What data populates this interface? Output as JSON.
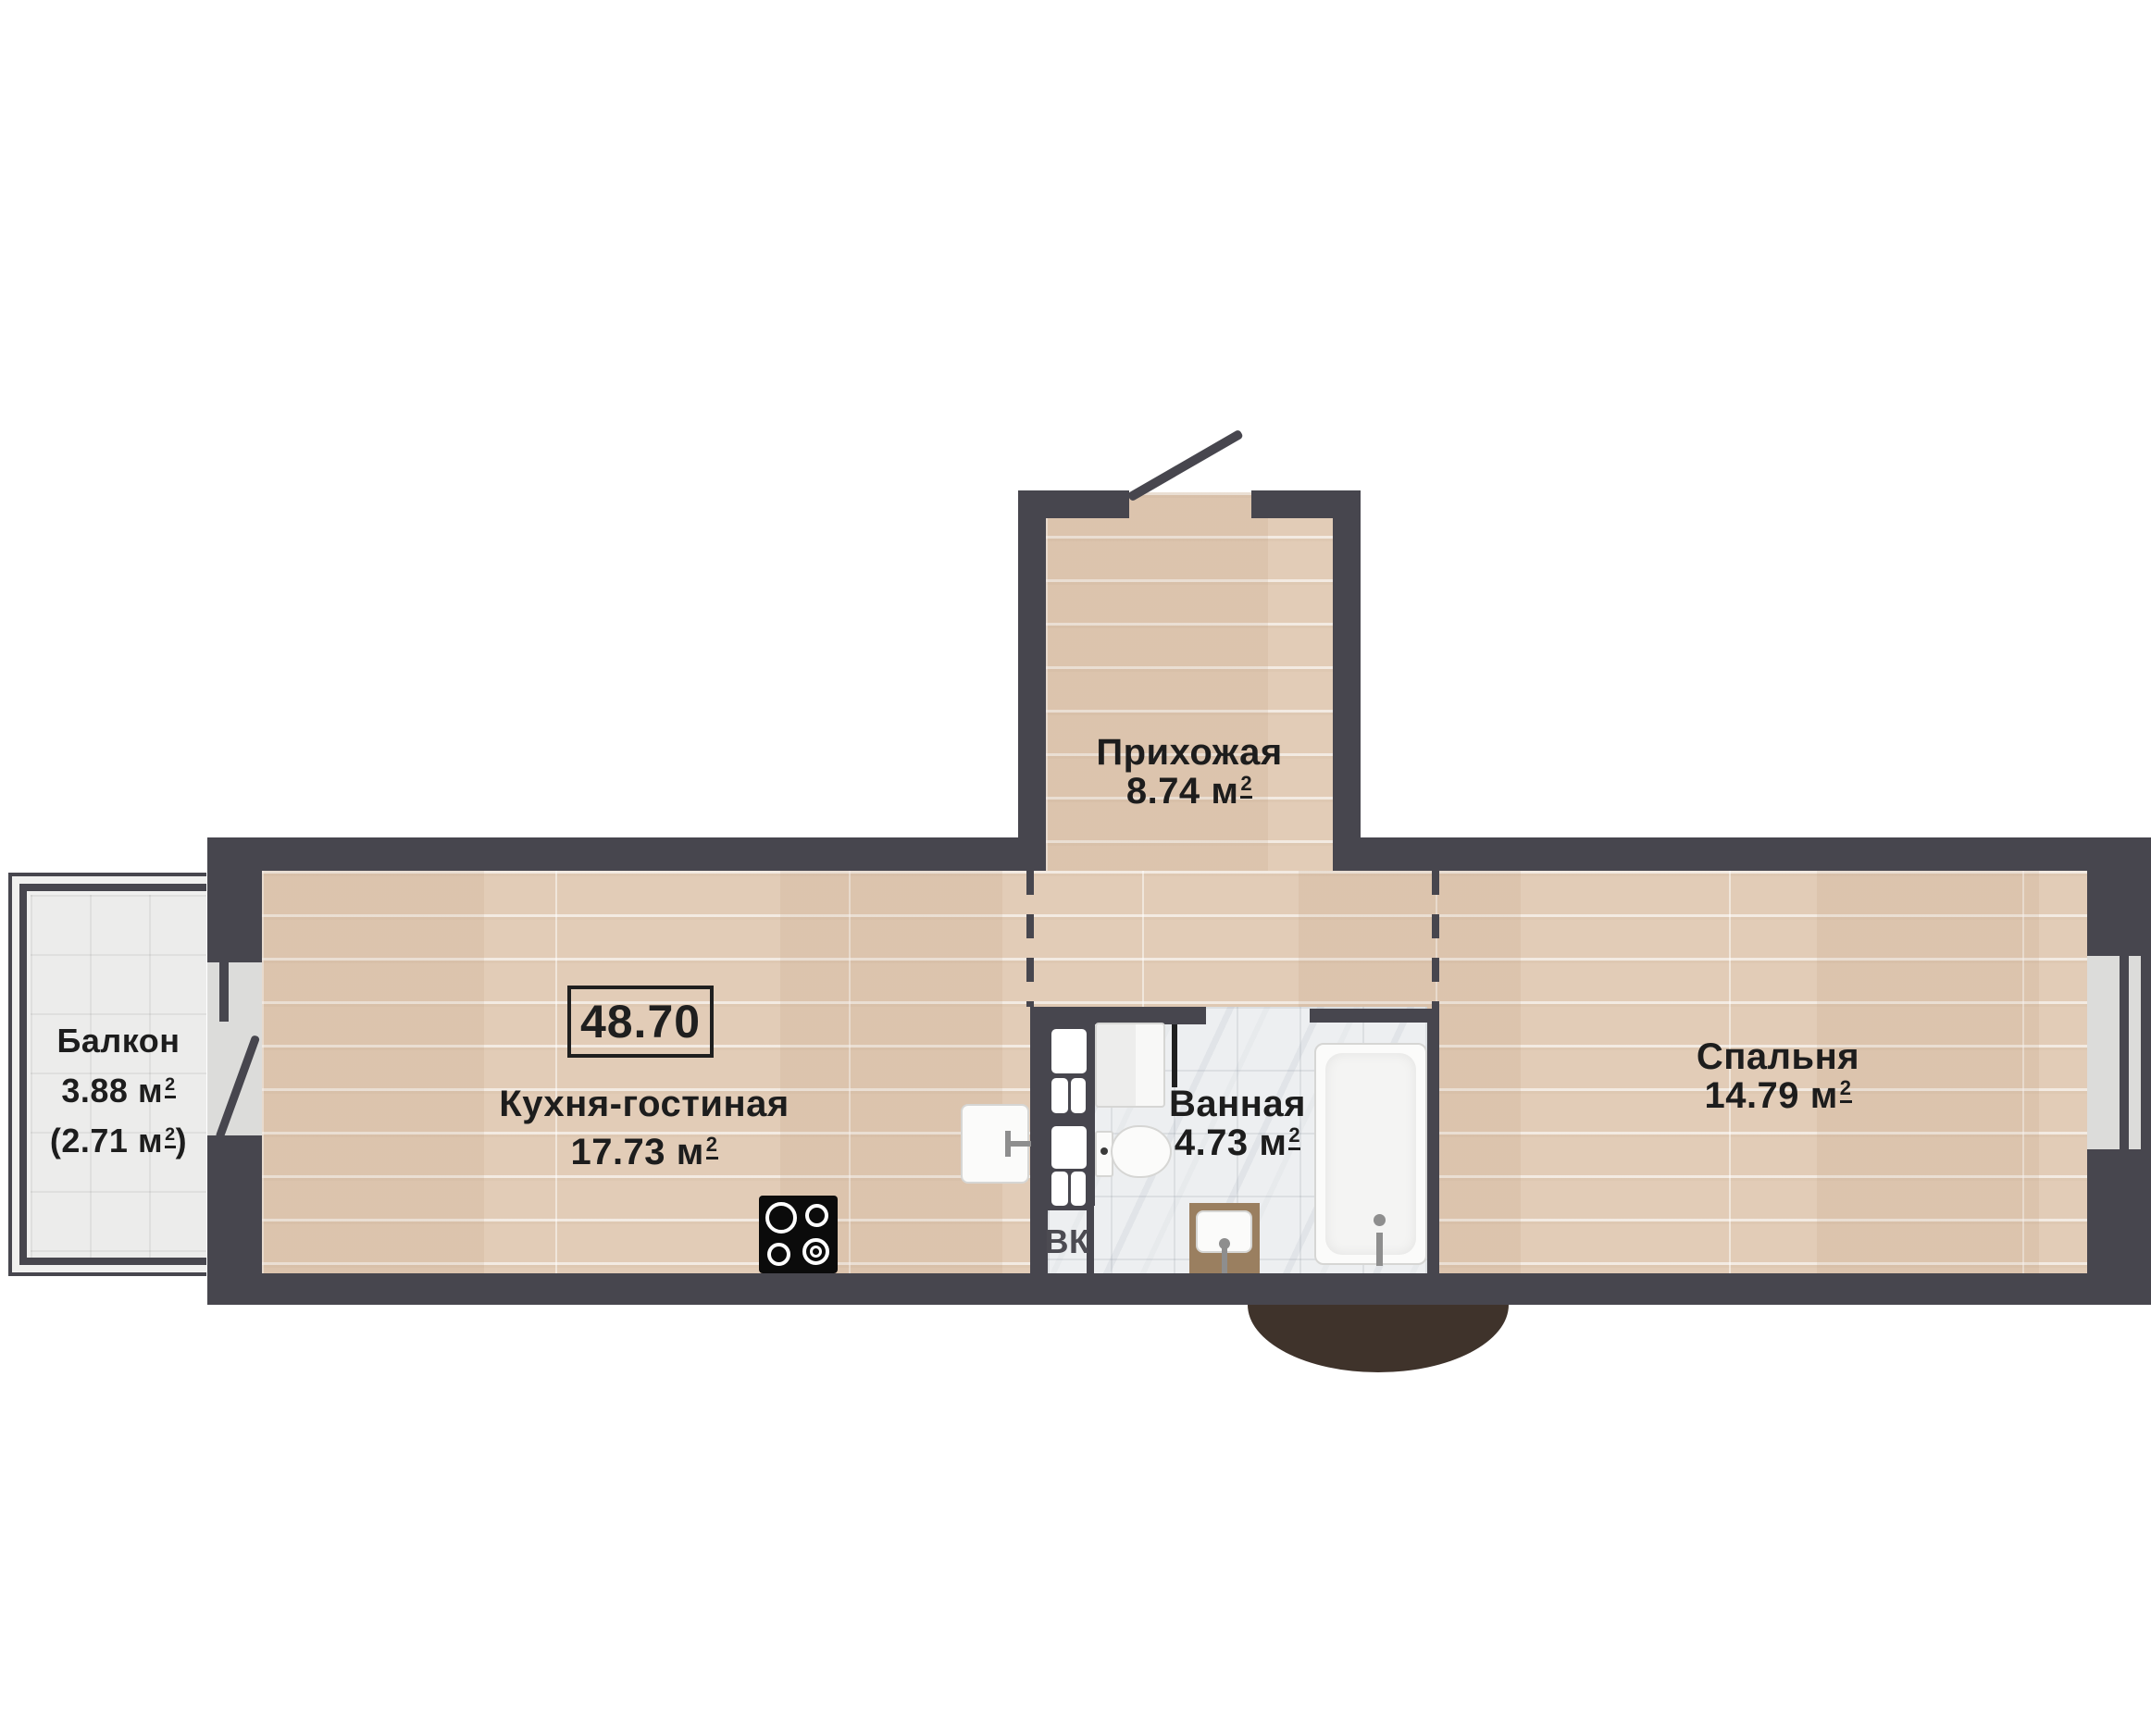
{
  "total_area": "48.70",
  "unit": {
    "letter": "м",
    "sup": "2"
  },
  "rooms": {
    "hallway": {
      "name": "Прихожая",
      "area": "8.74"
    },
    "kitchen_living": {
      "name": "Кухня-гостиная",
      "area": "17.73"
    },
    "bathroom": {
      "name": "Ванная",
      "area": "4.73"
    },
    "bedroom": {
      "name": "Спальня",
      "area": "14.79"
    },
    "balcony": {
      "name": "Балкон",
      "area": "3.88",
      "paren_open": "(",
      "area_reduced": "2.71",
      "paren_close": ")"
    }
  },
  "annotations": {
    "duct_label": "ВК"
  },
  "colors": {
    "wall": "#47464e",
    "wood_floor": "#e2ccb7",
    "tile_floor": "#ececeb",
    "marble_floor": "#edeff1",
    "window_fill": "#dcdcda",
    "entry_arc": "#3f332b",
    "text": "#1d1d1d"
  }
}
